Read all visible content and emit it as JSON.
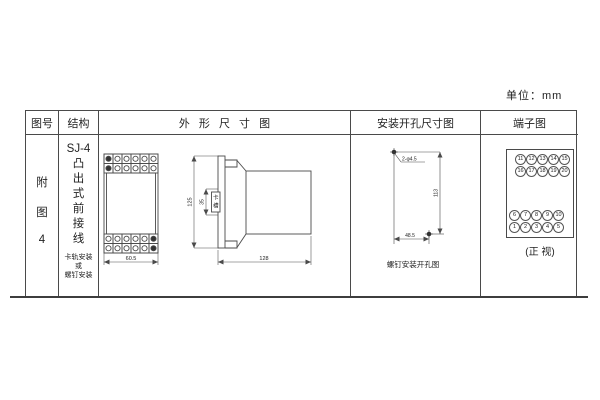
{
  "unit_note": "单位：mm",
  "headers": {
    "fig_no": "图号",
    "structure": "结构",
    "outline": "外 形 尺 寸 图",
    "mounting": "安装开孔尺寸图",
    "terminal": "端子图"
  },
  "fig_no": {
    "chars": [
      "附",
      "图",
      "4"
    ]
  },
  "structure": {
    "model": "SJ-4",
    "type_chars": [
      "凸",
      "出",
      "式",
      "前",
      "接",
      "线"
    ],
    "mount_note": [
      "卡轨安装",
      "或",
      "螺钉安装"
    ]
  },
  "outline": {
    "front": {
      "width_dim": "60.5",
      "terminal_cols": 6,
      "terminal_rows": 2
    },
    "side": {
      "height_dim": "125",
      "depth_dim": "128",
      "slot_dim": "35",
      "slot_label_chars": [
        "卡",
        "槽"
      ]
    }
  },
  "mounting": {
    "holes_label": "2-φ4.5",
    "vertical_dim": "113",
    "horizontal_dim": "48.5",
    "caption": "螺钉安装开孔图"
  },
  "terminal": {
    "caption": "(正 视)",
    "groups": [
      {
        "align": "right",
        "rows": [
          [
            "11",
            "12",
            "13",
            "14",
            "15"
          ],
          [
            "16",
            "17",
            "18",
            "19",
            "20"
          ]
        ]
      },
      {
        "align": "left",
        "rows": [
          [
            "6",
            "7",
            "8",
            "9",
            "10"
          ],
          [
            "1",
            "2",
            "3",
            "4",
            "5"
          ]
        ]
      }
    ]
  }
}
